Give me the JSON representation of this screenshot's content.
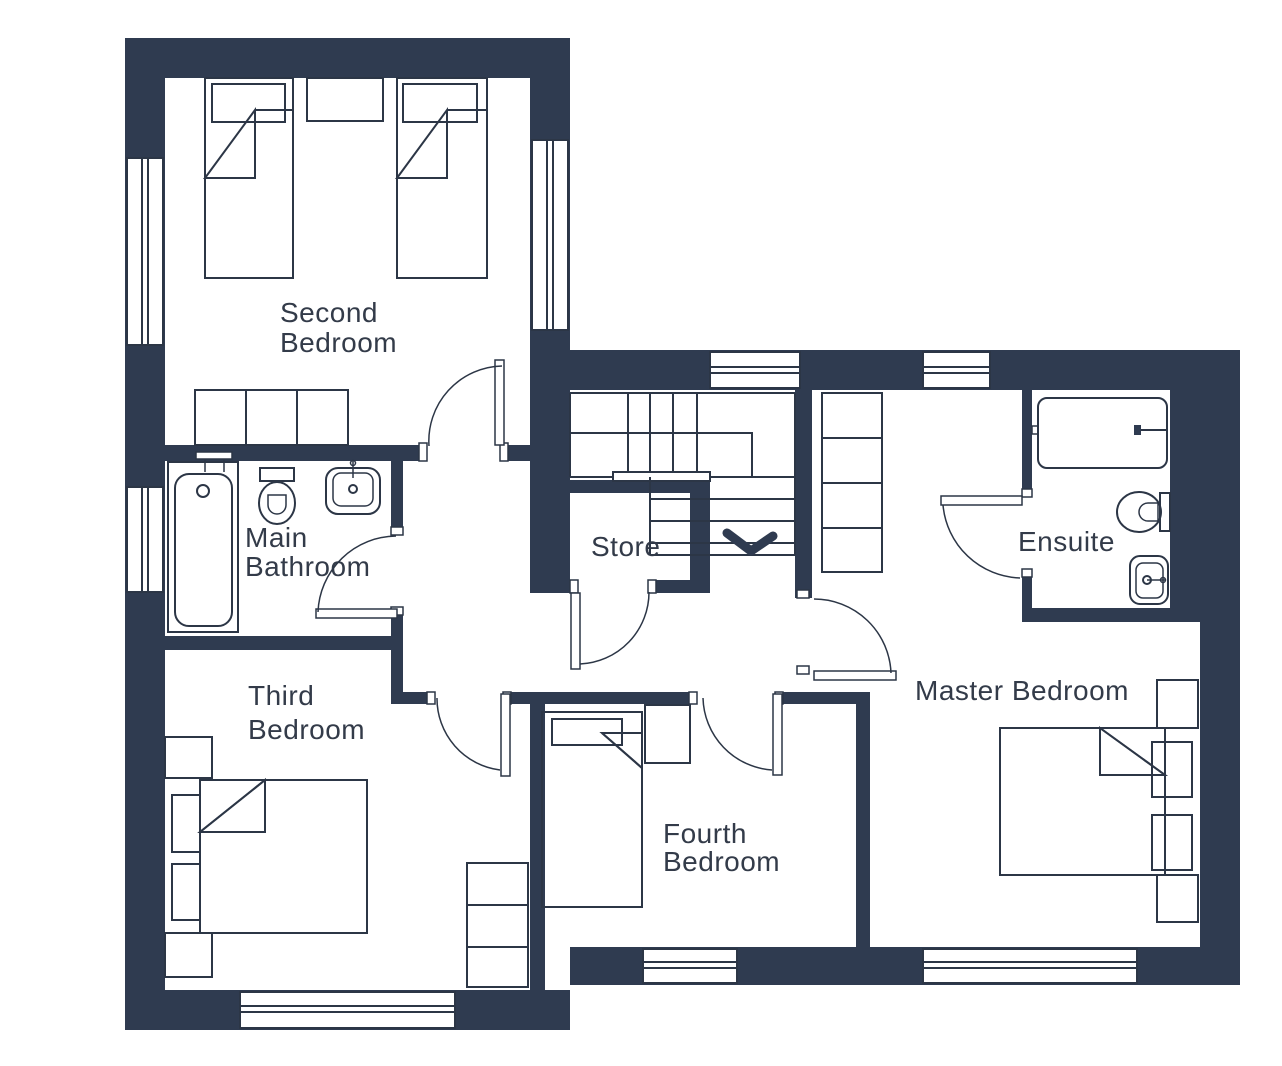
{
  "colors": {
    "wall": "#2F3B50",
    "line": "#2C3646",
    "text": "#333B49",
    "background": "#FFFFFF"
  },
  "rooms": {
    "second_bedroom": {
      "line1": "Second",
      "line2": "Bedroom"
    },
    "main_bathroom": {
      "line1": "Main",
      "line2": "Bathroom"
    },
    "store": {
      "label": "Store"
    },
    "ensuite": {
      "label": "Ensuite"
    },
    "master_bedroom": {
      "label": "Master Bedroom"
    },
    "third_bedroom": {
      "line1": "Third",
      "line2": "Bedroom"
    },
    "fourth_bedroom": {
      "line1": "Fourth",
      "line2": "Bedroom"
    }
  },
  "symbols": {
    "stairs_arrow": "chevron-down"
  }
}
